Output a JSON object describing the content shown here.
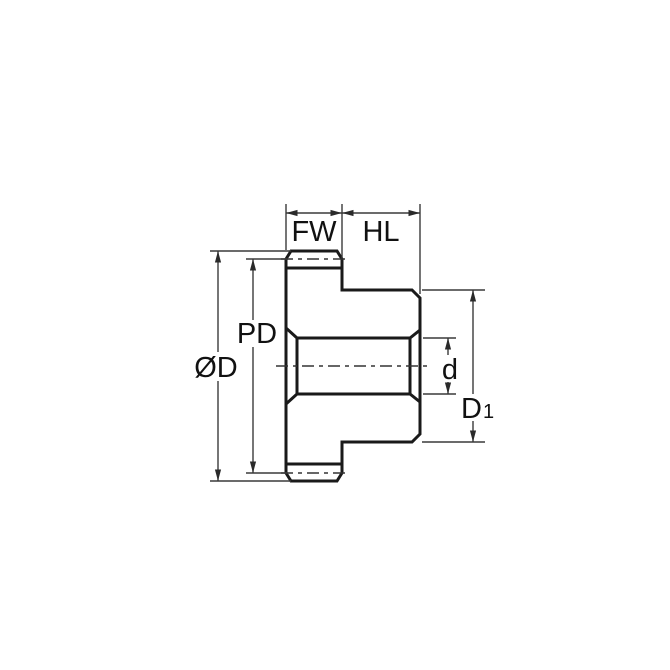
{
  "diagram": {
    "labels": {
      "face_width": "FW",
      "hub_length": "HL",
      "outside_diameter": "ØD",
      "pitch_diameter": "PD",
      "bore_diameter": "d",
      "hub_diameter_base": "D",
      "hub_diameter_sub": "1"
    },
    "colors": {
      "part_fill": "#CDE7F8",
      "outline": "#1A1A1A",
      "dimension_lines": "#3A3A3A",
      "background": "#FFFFFF"
    }
  }
}
